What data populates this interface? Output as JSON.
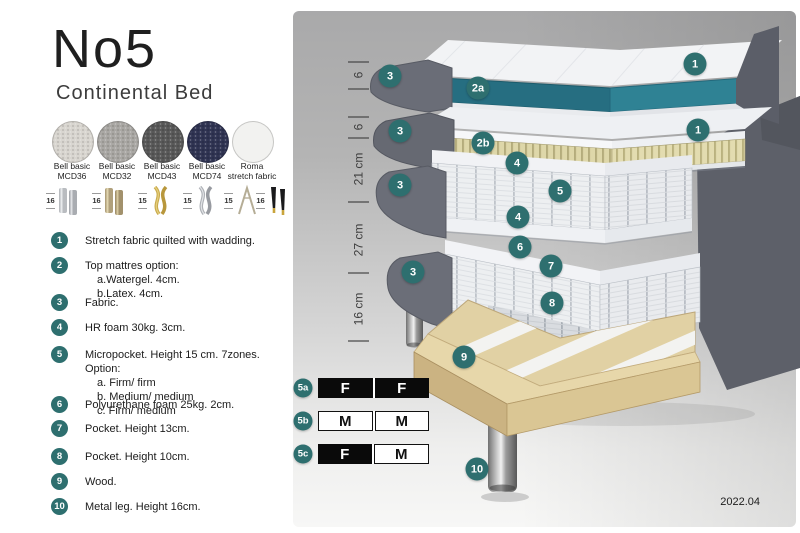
{
  "title": "No5",
  "subtitle": "Continental Bed",
  "fabrics": [
    {
      "name": "Bell basic",
      "code": "MCD36",
      "color": "#d8d5cf"
    },
    {
      "name": "Bell basic",
      "code": "MCD32",
      "color": "#a9a7a3"
    },
    {
      "name": "Bell basic",
      "code": "MCD43",
      "color": "#585858"
    },
    {
      "name": "Bell basic",
      "code": "MCD74",
      "color": "#2f3352"
    },
    {
      "name": "Roma",
      "code": "stretch fabric",
      "color": "#f2f2f0"
    }
  ],
  "legs_options": [
    {
      "height": "16",
      "type": "cylinder-silver"
    },
    {
      "height": "16",
      "type": "cylinder-bronze"
    },
    {
      "height": "15",
      "type": "twist-gold"
    },
    {
      "height": "15",
      "type": "twist-silver"
    },
    {
      "height": "15",
      "type": "hairpin"
    },
    {
      "height": "16",
      "type": "tapered-black-gold"
    }
  ],
  "features": [
    {
      "num": "1",
      "text": "Stretch fabric quilted with wadding.",
      "sub": []
    },
    {
      "num": "2",
      "text": "Top mattres option:",
      "sub": [
        "a.Watergel. 4cm.",
        "b.Latex. 4cm."
      ]
    },
    {
      "num": "3",
      "text": "Fabric.",
      "sub": []
    },
    {
      "num": "4",
      "text": "HR foam 30kg. 3cm.",
      "sub": []
    },
    {
      "num": "5",
      "text": "Micropocket. Height 15 cm. 7zones. Option:",
      "sub": [
        "a. Firm/ firm",
        "b. Medium/ medium",
        "c. Firm/ medium"
      ]
    },
    {
      "num": "6",
      "text": "Polyurethane foam 25kg. 2cm.",
      "sub": []
    },
    {
      "num": "7",
      "text": "Pocket. Height 13cm.",
      "sub": []
    },
    {
      "num": "8",
      "text": "Pocket. Height 10cm.",
      "sub": []
    },
    {
      "num": "9",
      "text": "Wood.",
      "sub": []
    },
    {
      "num": "10",
      "text": "Metal leg. Height 16cm.",
      "sub": []
    }
  ],
  "diagram": {
    "dimensions": [
      "6",
      "6",
      "21 cm",
      "27 cm",
      "16 cm"
    ],
    "callouts": [
      "1",
      "3",
      "2a",
      "1",
      "3",
      "2b",
      "4",
      "5",
      "3",
      "4",
      "6",
      "7",
      "3",
      "8",
      "9",
      "10"
    ],
    "firmness_table": [
      {
        "id": "5a",
        "cells": [
          {
            "text": "F",
            "variant": "dark"
          },
          {
            "text": "F",
            "variant": "dark"
          }
        ]
      },
      {
        "id": "5b",
        "cells": [
          {
            "text": "M",
            "variant": "light"
          },
          {
            "text": "M",
            "variant": "light"
          }
        ]
      },
      {
        "id": "5c",
        "cells": [
          {
            "text": "F",
            "variant": "dark"
          },
          {
            "text": "M",
            "variant": "light"
          }
        ]
      }
    ],
    "date": "2022.04",
    "badge_color": "#2e6f6f"
  },
  "colors": {
    "accent_badge": "#2e6f6f",
    "watergel_teal": "#2f8294",
    "latex_cream": "#ded7a9",
    "fabric_gray": "#6a6d77",
    "wood": "#e1d1a4"
  }
}
